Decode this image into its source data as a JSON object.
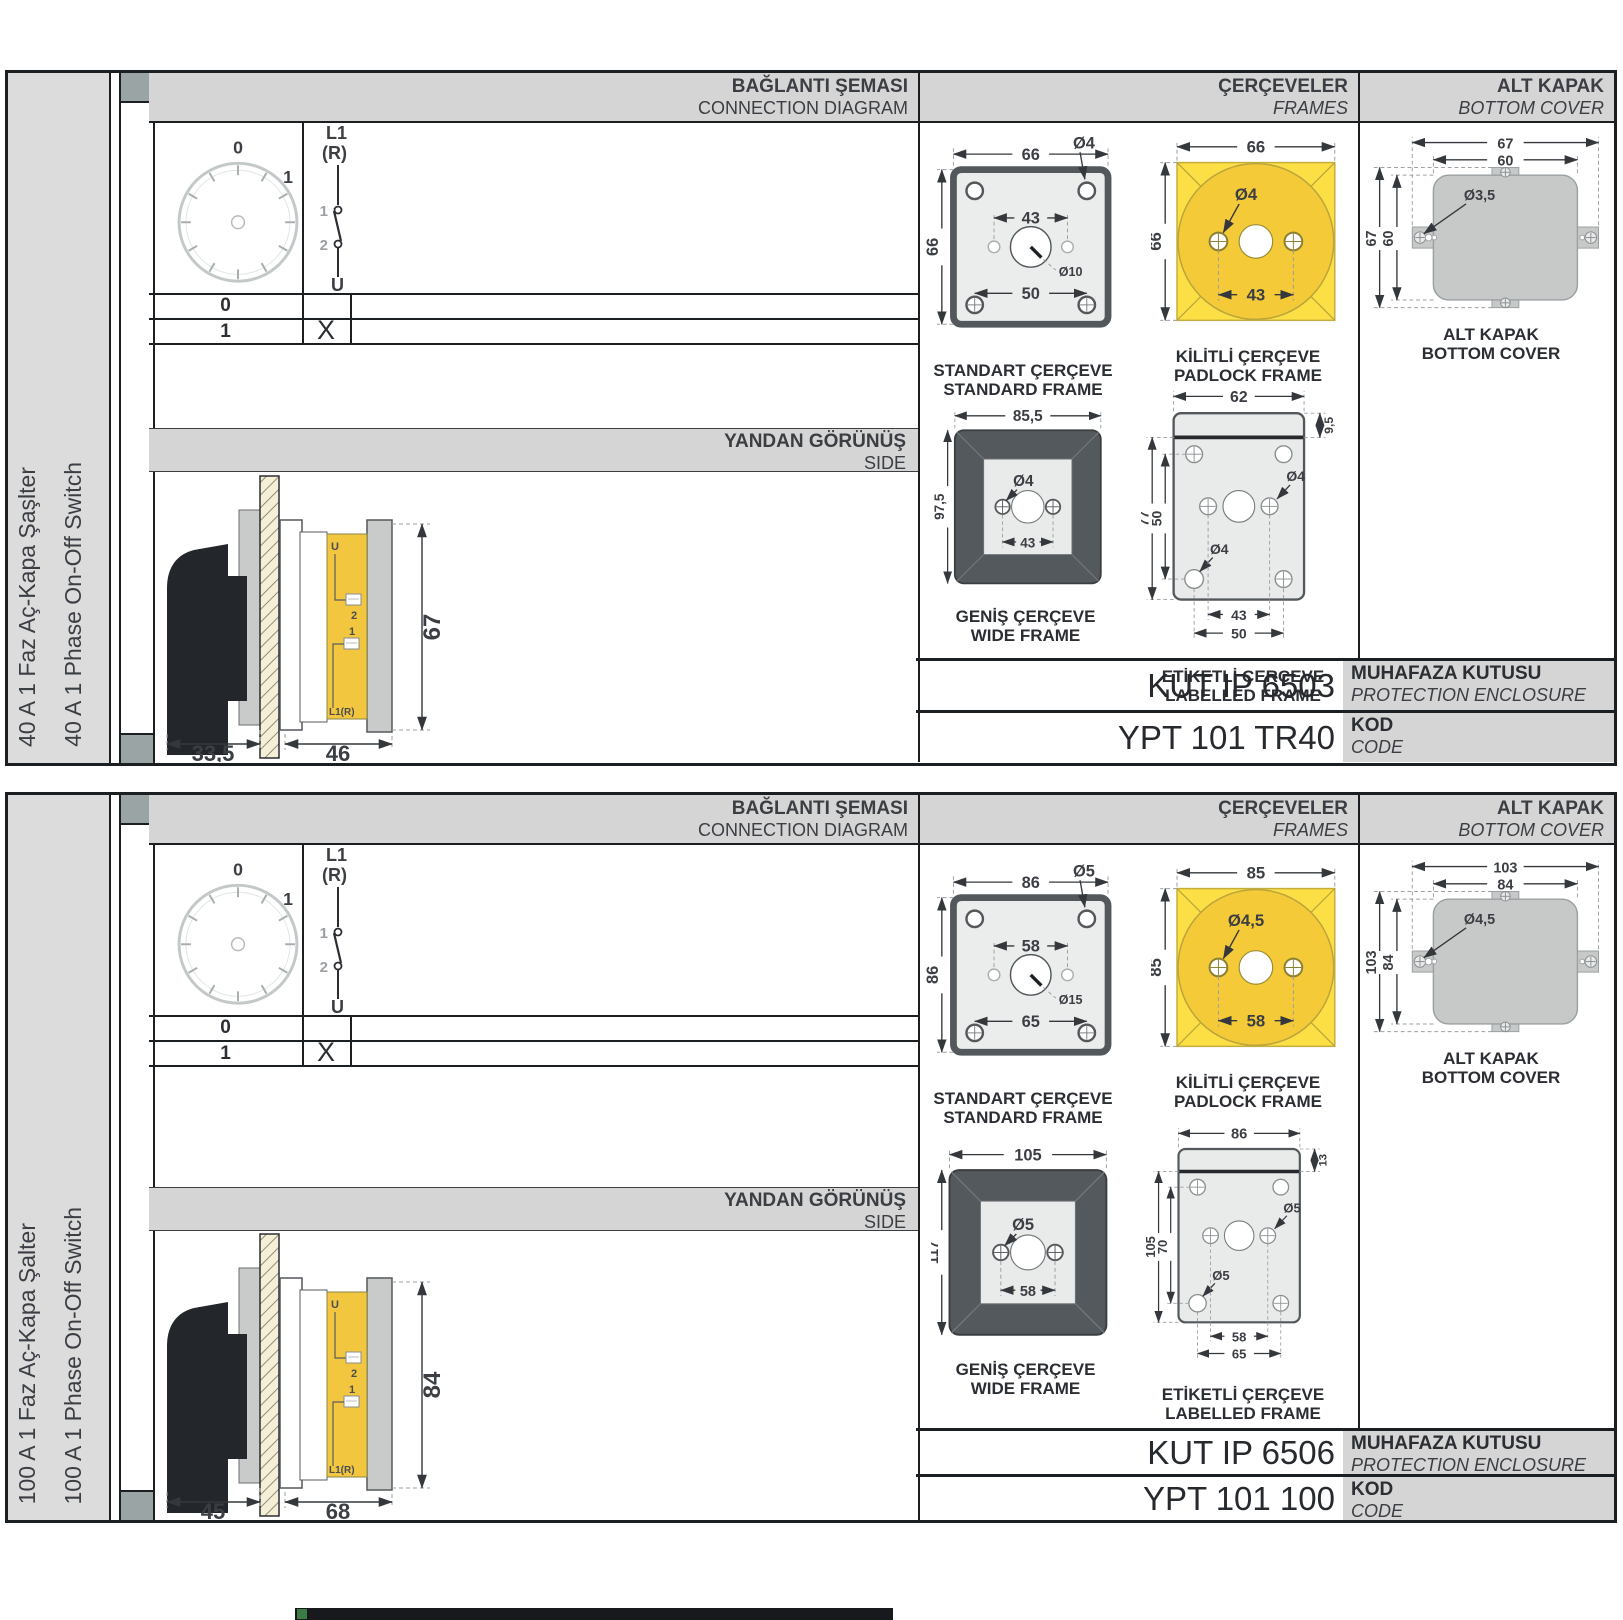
{
  "colors": {
    "accent_yellow": "#f4ca38",
    "padlock_square": "#fcdf45",
    "frame_dark_gray": "#54595d",
    "header_gray": "#d5d5d5",
    "cover_gray": "#c7c9c9",
    "footer_bar": "#17191c",
    "footer_accent": "#3a7d44"
  },
  "s": [
    {
      "label_tr": "40 A 1 Faz Aç-Kapa Şaşlter",
      "label_en": "40 A 1 Phase On-Off Switch",
      "headers": {
        "conn_tr": "BAĞLANTI ŞEMASI",
        "conn_en": "CONNECTION DIAGRAM",
        "frames_tr": "ÇERÇEVELER",
        "frames_en": "FRAMES",
        "cover_tr": "ALT KAPAK",
        "cover_en": "BOTTOM COVER",
        "side_tr": "YANDAN GÖRÜNÜŞ",
        "side_en": "SIDE"
      },
      "diagram": {
        "pos0": "0",
        "pos1": "1",
        "l1": "L1",
        "r": "(R)",
        "c1": "1",
        "c2": "2",
        "u": "U",
        "row0": {
          "pos": "0",
          "mark": ""
        },
        "row1": {
          "pos": "1",
          "mark": "X"
        }
      },
      "side": {
        "d_handle": "33,5",
        "d_body": "46",
        "h": "67",
        "t_u": "U",
        "t_2": "2",
        "t_1": "1",
        "t_l1r": "L1(R)"
      },
      "std": {
        "w": "66",
        "h": "66",
        "screw": "Ø4",
        "span": "43",
        "shaft": "Ø10",
        "span2": "50",
        "cap_tr": "STANDART ÇERÇEVE",
        "cap_en": "STANDARD FRAME"
      },
      "pad": {
        "w": "66",
        "h": "66",
        "screw": "Ø4",
        "span": "43",
        "cap_tr": "KİLİTLİ ÇERÇEVE",
        "cap_en": "PADLOCK FRAME"
      },
      "wide": {
        "w": "85,5",
        "h": "97,5",
        "screw": "Ø4",
        "span": "43",
        "cap_tr": "GENİŞ ÇERÇEVE",
        "cap_en": "WIDE FRAME"
      },
      "lab": {
        "w": "62",
        "strip": "9,5",
        "h": "77",
        "h_in": "50",
        "screw_a": "Ø4",
        "screw_b": "Ø4",
        "span_a": "43",
        "span_b": "50",
        "cap_tr": "ETİKETLİ ÇERÇEVE",
        "cap_en": "LABELLED FRAME"
      },
      "cover": {
        "w_out": "67",
        "w_in": "60",
        "screw": "Ø3,5",
        "h_out": "67",
        "h_in": "60",
        "cap_tr": "ALT KAPAK",
        "cap_en": "BOTTOM COVER"
      },
      "codes": {
        "enc_val": "KUT IP 6503",
        "enc_tr": "MUHAFAZA KUTUSU",
        "enc_en": "PROTECTION ENCLOSURE",
        "code_val": "YPT 101 TR40",
        "code_tr": "KOD",
        "code_en": "CODE"
      }
    },
    {
      "label_tr": "100 A 1 Faz Aç-Kapa Şalter",
      "label_en": "100 A 1 Phase On-Off Switch",
      "headers": {
        "conn_tr": "BAĞLANTI ŞEMASI",
        "conn_en": "CONNECTION DIAGRAM",
        "frames_tr": "ÇERÇEVELER",
        "frames_en": "FRAMES",
        "cover_tr": "ALT KAPAK",
        "cover_en": "BOTTOM COVER",
        "side_tr": "YANDAN GÖRÜNÜŞ",
        "side_en": "SIDE"
      },
      "diagram": {
        "pos0": "0",
        "pos1": "1",
        "l1": "L1",
        "r": "(R)",
        "c1": "1",
        "c2": "2",
        "u": "U",
        "row0": {
          "pos": "0",
          "mark": ""
        },
        "row1": {
          "pos": "1",
          "mark": "X"
        }
      },
      "side": {
        "d_handle": "45",
        "d_body": "68",
        "h": "84",
        "t_u": "U",
        "t_2": "2",
        "t_1": "1",
        "t_l1r": "L1(R)"
      },
      "std": {
        "w": "86",
        "h": "86",
        "screw": "Ø5",
        "span": "58",
        "shaft": "Ø15",
        "span2": "65",
        "cap_tr": "STANDART ÇERÇEVE",
        "cap_en": "STANDARD FRAME"
      },
      "pad": {
        "w": "85",
        "h": "85",
        "screw": "Ø4,5",
        "span": "58",
        "cap_tr": "KİLİTLİ ÇERÇEVE",
        "cap_en": "PADLOCK FRAME"
      },
      "wide": {
        "w": "105",
        "h": "117",
        "screw": "Ø5",
        "span": "58",
        "cap_tr": "GENİŞ ÇERÇEVE",
        "cap_en": "WIDE FRAME"
      },
      "lab": {
        "w": "86",
        "strip": "13",
        "h": "105",
        "h_in": "70",
        "screw_a": "Ø5",
        "screw_b": "Ø5",
        "span_a": "58",
        "span_b": "65",
        "cap_tr": "ETİKETLİ ÇERÇEVE",
        "cap_en": "LABELLED FRAME"
      },
      "cover": {
        "w_out": "103",
        "w_in": "84",
        "screw": "Ø4,5",
        "h_out": "103",
        "h_in": "84",
        "cap_tr": "ALT KAPAK",
        "cap_en": "BOTTOM COVER"
      },
      "codes": {
        "enc_val": "KUT IP 6506",
        "enc_tr": "MUHAFAZA KUTUSU",
        "enc_en": "PROTECTION ENCLOSURE",
        "code_val": "YPT 101 100",
        "code_tr": "KOD",
        "code_en": "CODE"
      }
    }
  ]
}
